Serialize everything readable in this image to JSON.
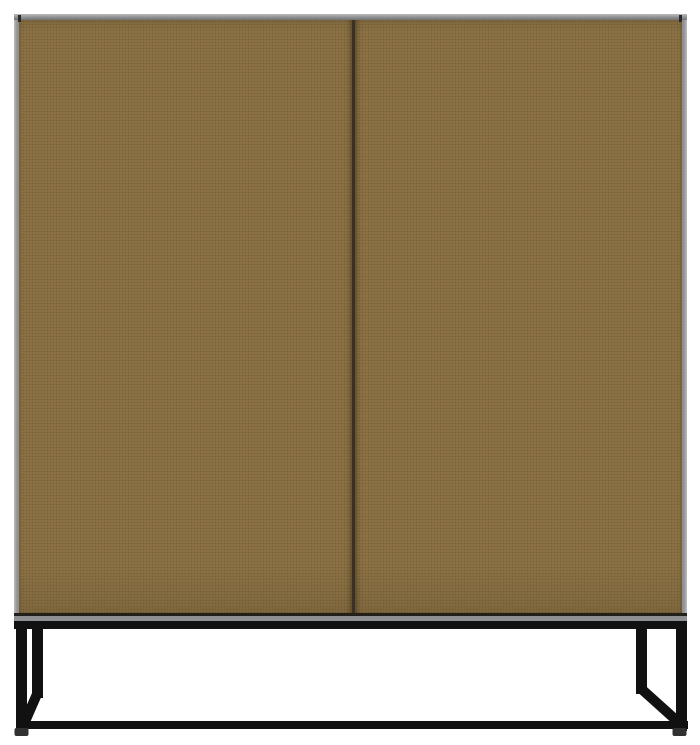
{
  "image": {
    "type": "product-photo",
    "subject": "Closed two-door cabinet in olive-brown with grey carcass edges standing on a black metal sled-frame base, front view on white background"
  },
  "colors": {
    "background": "#ffffff",
    "door": "#8b7144",
    "door_seam": "#3a3126",
    "door_shadow": "#232019",
    "carcass_edge": "#8e9092",
    "carcass_edge_light": "#babcbe",
    "carcass_edge_dark": "#6f7173",
    "metal": "#111111",
    "foot": "#313131"
  }
}
